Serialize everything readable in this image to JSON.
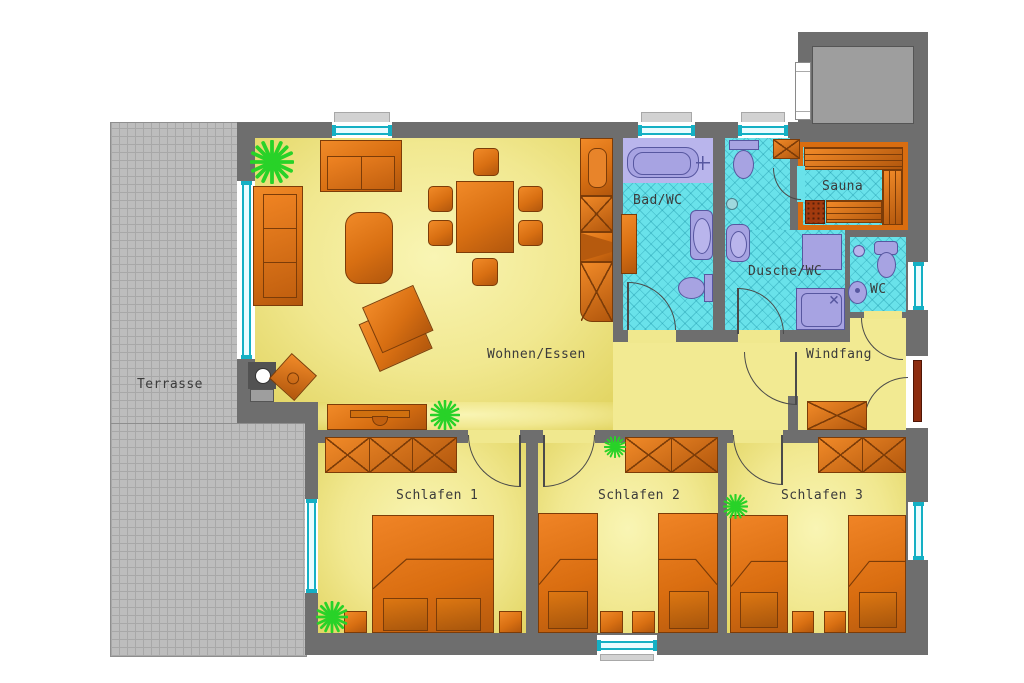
{
  "plan_title": "Apartment floor plan",
  "rooms": {
    "terrasse": {
      "label": "Terrasse"
    },
    "wohnen_essen": {
      "label": "Wohnen/Essen"
    },
    "bad_wc": {
      "label": "Bad/WC"
    },
    "dusche_wc": {
      "label": "Dusche/WC"
    },
    "sauna": {
      "label": "Sauna"
    },
    "wc": {
      "label": "WC"
    },
    "windfang": {
      "label": "Windfang"
    },
    "schlafen_1": {
      "label": "Schlafen 1"
    },
    "schlafen_2": {
      "label": "Schlafen 2"
    },
    "schlafen_3": {
      "label": "Schlafen 3"
    }
  },
  "colors": {
    "wall": "#6e6e6e",
    "terrace_gray": "#bdbdbd",
    "floor_yellow": "#f0e78e",
    "tile_cyan": "#69e2ea",
    "furniture_orange": "#ef8322",
    "fixture_purple": "#a7a3e2",
    "plant_green": "#28d228",
    "window_cyan": "#14b0c4",
    "entrance_door_brown": "#8d2d10",
    "annex_gray": "#9e9e9e"
  }
}
